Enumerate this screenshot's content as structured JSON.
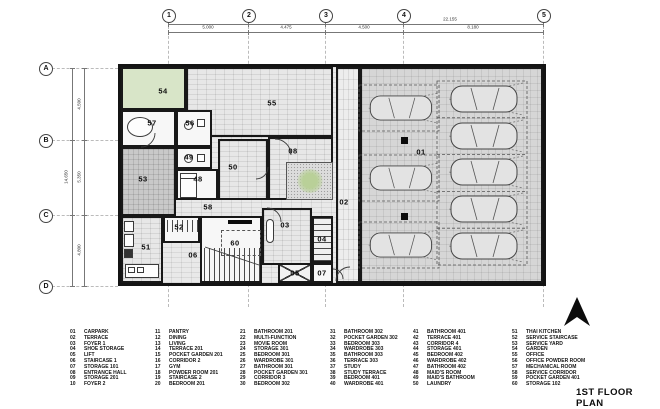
{
  "title": "1ST FLOOR PLAN",
  "grid": {
    "cols": [
      "1",
      "2",
      "3",
      "4",
      "5"
    ],
    "rows": [
      "A",
      "B",
      "C",
      "D"
    ]
  },
  "dimensions": {
    "top_total": "22.155",
    "top_segments": [
      "5.000",
      "4.475",
      "4.500",
      "8.180"
    ],
    "left_total": "14.650",
    "left_segments": [
      "4.500",
      "5.350",
      "4.800"
    ]
  },
  "plan": {
    "room_labels": [
      "54",
      "55",
      "57",
      "56",
      "49",
      "48",
      "50",
      "53",
      "08",
      "58",
      "52",
      "51",
      "06",
      "60",
      "03",
      "04",
      "05",
      "07",
      "02",
      "01"
    ],
    "carpark": {
      "left_stalls": 3,
      "right_stalls": 5
    }
  },
  "legend": {
    "columns": [
      [
        {
          "n": "01",
          "t": "CARPARK"
        },
        {
          "n": "02",
          "t": "TERRACE"
        },
        {
          "n": "03",
          "t": "FOYER 1"
        },
        {
          "n": "04",
          "t": "SHOE STORAGE"
        },
        {
          "n": "05",
          "t": "LIFT"
        },
        {
          "n": "06",
          "t": "STAIRCASE 1"
        },
        {
          "n": "07",
          "t": "STORAGE 101"
        },
        {
          "n": "08",
          "t": "ENTRANCE HALL"
        },
        {
          "n": "09",
          "t": "STORAGE 201"
        },
        {
          "n": "10",
          "t": "FOYER 2"
        }
      ],
      [
        {
          "n": "11",
          "t": "PANTRY"
        },
        {
          "n": "12",
          "t": "DINING"
        },
        {
          "n": "13",
          "t": "LIVING"
        },
        {
          "n": "14",
          "t": "TERRACE 201"
        },
        {
          "n": "15",
          "t": "POCKET GARDEN 201"
        },
        {
          "n": "16",
          "t": "CORRIDOR 2"
        },
        {
          "n": "17",
          "t": "GYM"
        },
        {
          "n": "18",
          "t": "POWDER ROOM 201"
        },
        {
          "n": "19",
          "t": "STAIRCASE 2"
        },
        {
          "n": "20",
          "t": "BEDROOM 201"
        }
      ],
      [
        {
          "n": "21",
          "t": "BATHROOM 201"
        },
        {
          "n": "22",
          "t": "MULTI-FUNCTION"
        },
        {
          "n": "23",
          "t": "MOVIE ROOM"
        },
        {
          "n": "24",
          "t": "STORAGE 301"
        },
        {
          "n": "25",
          "t": "BEDROOM 301"
        },
        {
          "n": "26",
          "t": "WARDROBE 301"
        },
        {
          "n": "27",
          "t": "BATHROOM 301"
        },
        {
          "n": "28",
          "t": "POCKET GARDEN 301"
        },
        {
          "n": "29",
          "t": "CORRIDOR 3"
        },
        {
          "n": "30",
          "t": "BEDROOM 302"
        }
      ],
      [
        {
          "n": "31",
          "t": "BATHROOM 302"
        },
        {
          "n": "32",
          "t": "POCKET GARDEN 302"
        },
        {
          "n": "33",
          "t": "BEDROOM 303"
        },
        {
          "n": "34",
          "t": "WARDROBE 303"
        },
        {
          "n": "35",
          "t": "BATHROOM 303"
        },
        {
          "n": "36",
          "t": "TERRACE 303"
        },
        {
          "n": "37",
          "t": "STUDY"
        },
        {
          "n": "38",
          "t": "STUDY TERRACE"
        },
        {
          "n": "39",
          "t": "BEDROOM 401"
        },
        {
          "n": "40",
          "t": "WARDROBE 401"
        }
      ],
      [
        {
          "n": "41",
          "t": "BATHROOM 401"
        },
        {
          "n": "42",
          "t": "TERRACE 401"
        },
        {
          "n": "43",
          "t": "CORRIDOR 4"
        },
        {
          "n": "44",
          "t": "STORAGE 401"
        },
        {
          "n": "45",
          "t": "BEDROOM 402"
        },
        {
          "n": "46",
          "t": "WARDROBE 402"
        },
        {
          "n": "47",
          "t": "BATHROOM 402"
        },
        {
          "n": "48",
          "t": "MAID'S ROOM"
        },
        {
          "n": "49",
          "t": "MAID'S BATHROOM"
        },
        {
          "n": "50",
          "t": "LAUNDRY"
        }
      ],
      [
        {
          "n": "51",
          "t": "THAI KITCHEN"
        },
        {
          "n": "52",
          "t": "SERVICE STAIRCASE"
        },
        {
          "n": "53",
          "t": "SERVICE YARD"
        },
        {
          "n": "54",
          "t": "GARDEN"
        },
        {
          "n": "55",
          "t": "OFFICE"
        },
        {
          "n": "56",
          "t": "OFFICE POWDER ROOM"
        },
        {
          "n": "57",
          "t": "MECHANICAL ROOM"
        },
        {
          "n": "58",
          "t": "SERVICE CORRIDOR"
        },
        {
          "n": "59",
          "t": "POCKET GARDEN 401"
        },
        {
          "n": "60",
          "t": "STORAGE 102"
        }
      ]
    ]
  },
  "colors": {
    "wall": "#141414",
    "garden_green": "#d8e5c8",
    "plant_green": "#b9d098"
  }
}
